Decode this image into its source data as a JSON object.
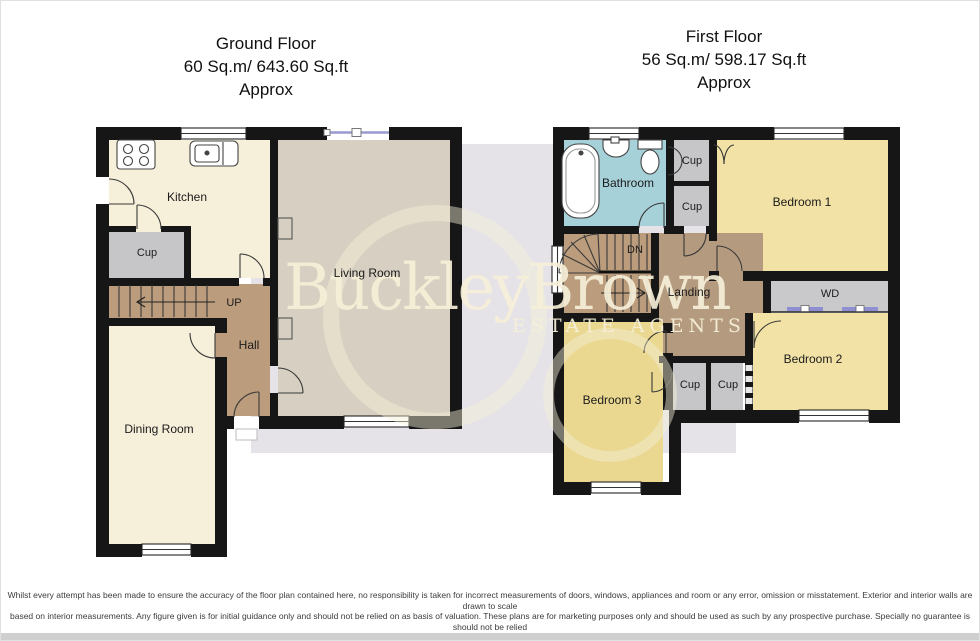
{
  "ground_floor": {
    "title_lines": [
      "Ground Floor",
      "60 Sq.m/ 643.60 Sq.ft",
      "Approx"
    ],
    "rooms": {
      "kitchen": "Kitchen",
      "cupboard": "Cup",
      "stairs": "UP",
      "hall": "Hall",
      "living_room": "Living Room",
      "dining_room": "Dining Room"
    }
  },
  "first_floor": {
    "title_lines": [
      "First Floor",
      "56 Sq.m/ 598.17 Sq.ft",
      "Approx"
    ],
    "rooms": {
      "bathroom": "Bathroom",
      "cupboard_top_1": "Cup",
      "cupboard_top_2": "Cup",
      "bedroom_1": "Bedroom 1",
      "stairs": "DN",
      "landing": "Landing",
      "wardrobe": "WD",
      "bedroom_2": "Bedroom 2",
      "bedroom_3": "Bedroom 3",
      "cupboard_bottom_1": "Cup",
      "cupboard_bottom_2": "Cup"
    }
  },
  "watermark": {
    "brand": "BuckleyBrown",
    "tagline": "ESTATE AGENTS"
  },
  "disclaimer": {
    "lines": [
      "Whilst every attempt has been made to ensure the accuracy of the floor plan contained here, no responsibility is taken for incorrect measurements of doors, windows, appliances and room or any error, omission or misstatement. Exterior and interior walls are drawn to scale",
      "based on interior measurements. Any figure given is for initial guidance only and should not be relied on as basis of valuation. These plans are for marketing purposes only and should be used as such by any prospective purchase. Specially no guarantee is should not be relied",
      "on as a basis of valuation. These plans are for marketing purposes only and should be used as such by any prospective purchase. Specifically no guarantee is given on the total square footage of the property if quoted on this plan.",
      "CC Ltd ©2018"
    ]
  },
  "colors": {
    "wall": "#161616",
    "kitchen_dining": "#f6efd9",
    "living_room": "#d7d0c2",
    "stairs_hall": "#bb9c7c",
    "landing": "#b49a7e",
    "bedroom": "#f2e2a6",
    "bedroom_3": "#ead891",
    "bathroom": "#a7d1d9",
    "cupboard": "#c6c6c8",
    "watermark_panel": "#e5e3e8",
    "watermark_text": "#f4eed6",
    "window_glass_line": "#9a99d0"
  }
}
